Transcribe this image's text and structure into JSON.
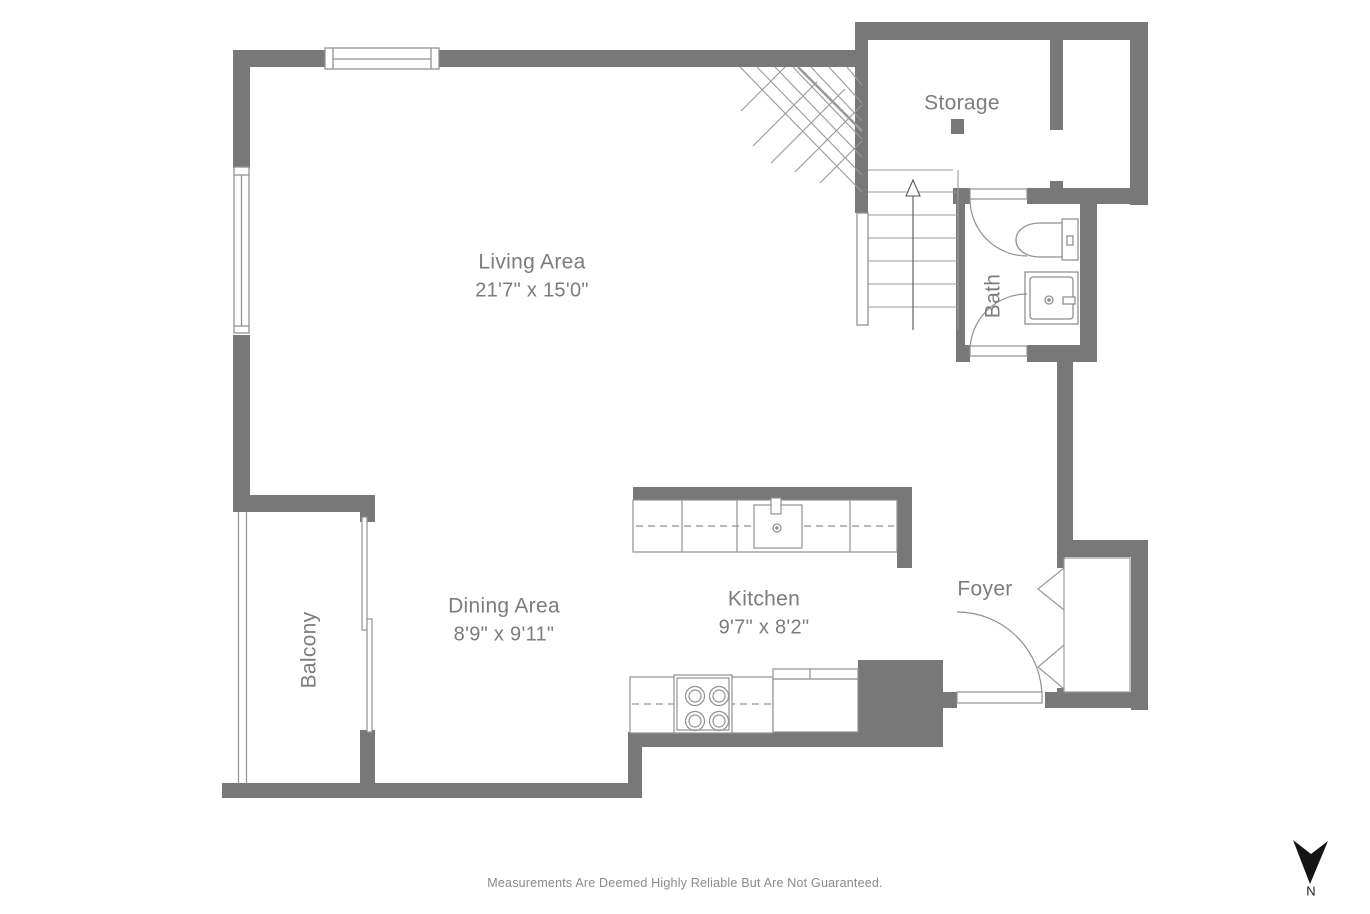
{
  "plan": {
    "rooms": {
      "living": {
        "name": "Living Area",
        "dims": "21'7\" x 15'0\""
      },
      "dining": {
        "name": "Dining Area",
        "dims": "8'9\" x 9'11\""
      },
      "kitchen": {
        "name": "Kitchen",
        "dims": "9'7\" x 8'2\""
      },
      "storage": {
        "name": "Storage"
      },
      "bath": {
        "name": "Bath"
      },
      "foyer": {
        "name": "Foyer"
      },
      "balcony": {
        "name": "Balcony"
      }
    },
    "compass": {
      "label": "N"
    },
    "disclaimer": "Measurements Are Deemed Highly Reliable But Are Not Guaranteed.",
    "colors": {
      "wall": "#787878",
      "line": "#919191",
      "label_text": "#7c7c7c",
      "compass": "#141414"
    }
  }
}
